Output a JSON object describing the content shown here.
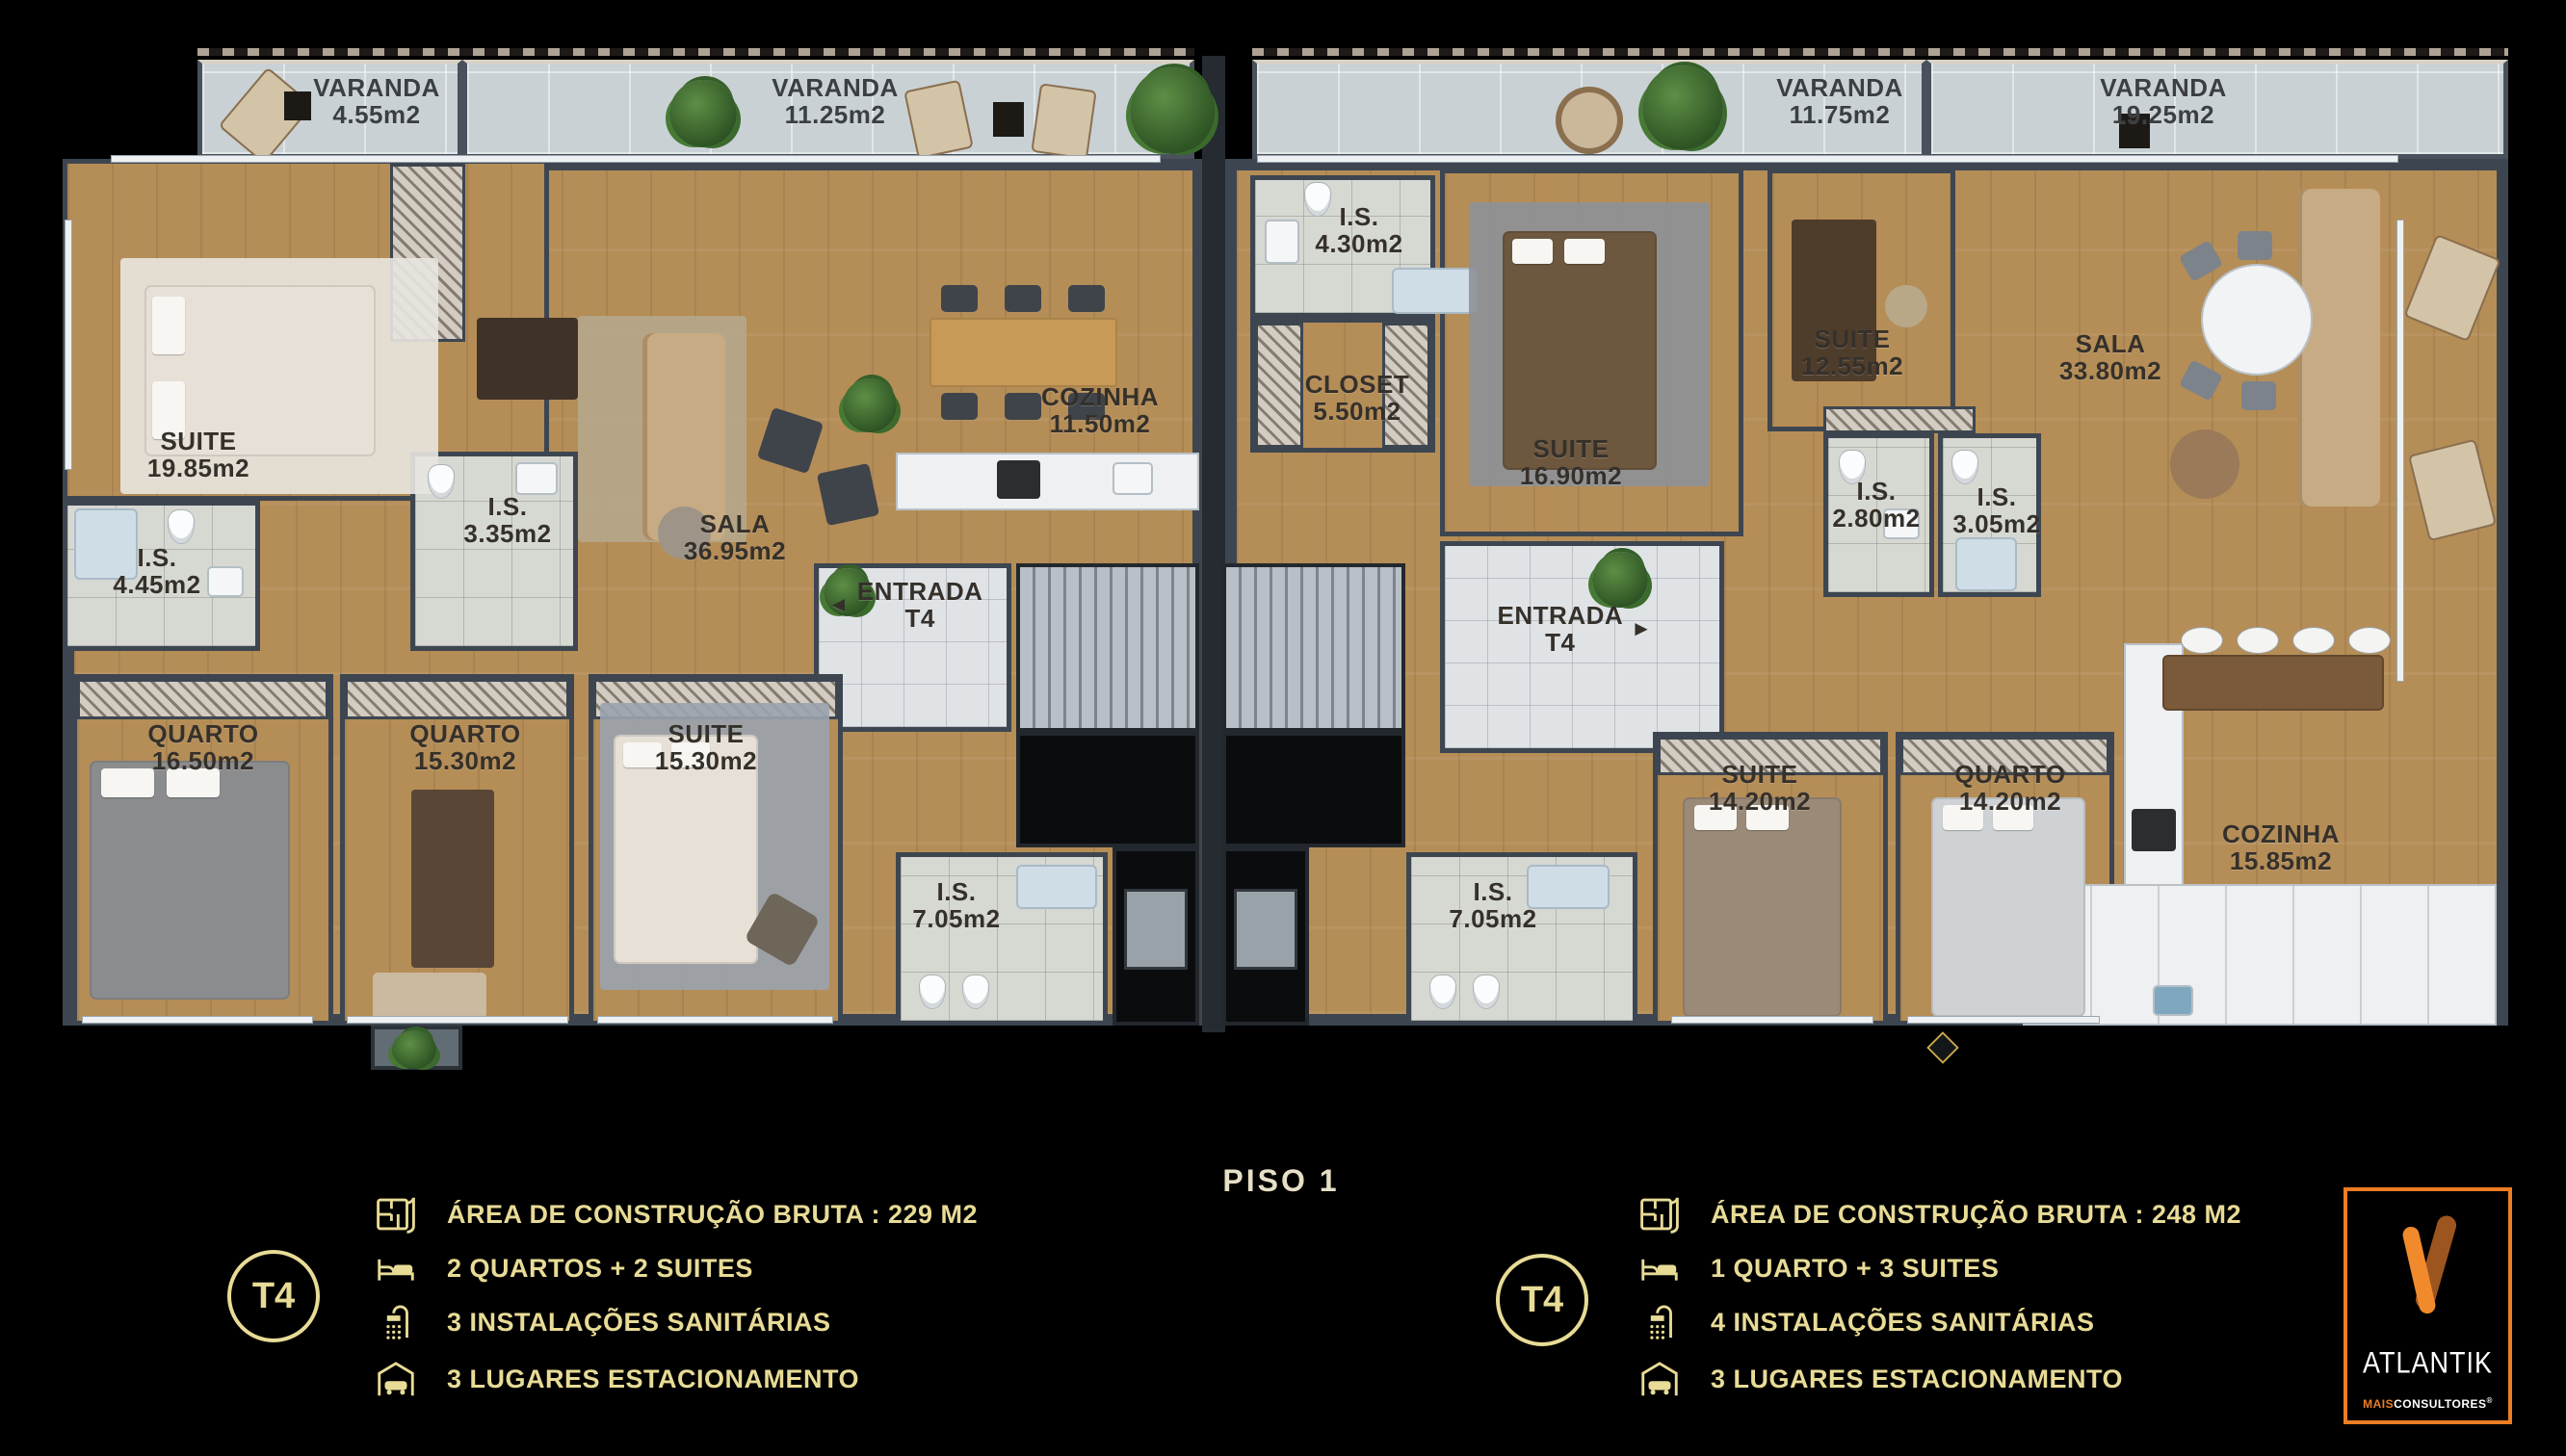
{
  "floor": {
    "label": "PISO 1"
  },
  "balconies": [
    {
      "name": "VARANDA",
      "area": "4.55m2"
    },
    {
      "name": "VARANDA",
      "area": "11.25m2"
    },
    {
      "name": "VARANDA",
      "area": "11.75m2"
    },
    {
      "name": "VARANDA",
      "area": "19.25m2"
    }
  ],
  "left_unit": {
    "rooms": [
      {
        "name": "SUITE",
        "area": "19.85m2"
      },
      {
        "name": "I.S.",
        "area": "4.45m2"
      },
      {
        "name": "I.S.",
        "area": "3.35m2"
      },
      {
        "name": "SALA",
        "area": "36.95m2"
      },
      {
        "name": "COZINHA",
        "area": "11.50m2"
      },
      {
        "name": "ENTRADA",
        "area": "T4"
      },
      {
        "name": "QUARTO",
        "area": "16.50m2"
      },
      {
        "name": "QUARTO",
        "area": "15.30m2"
      },
      {
        "name": "SUITE",
        "area": "15.30m2"
      },
      {
        "name": "I.S.",
        "area": "7.05m2"
      }
    ]
  },
  "right_unit": {
    "rooms": [
      {
        "name": "I.S.",
        "area": "4.30m2"
      },
      {
        "name": "CLOSET",
        "area": "5.50m2"
      },
      {
        "name": "SUITE",
        "area": "16.90m2"
      },
      {
        "name": "ENTRADA",
        "area": "T4"
      },
      {
        "name": "SUITE",
        "area": "12.55m2"
      },
      {
        "name": "I.S.",
        "area": "2.80m2"
      },
      {
        "name": "I.S.",
        "area": "3.05m2"
      },
      {
        "name": "SALA",
        "area": "33.80m2"
      },
      {
        "name": "I.S.",
        "area": "7.05m2"
      },
      {
        "name": "SUITE",
        "area": "14.20m2"
      },
      {
        "name": "QUARTO",
        "area": "14.20m2"
      },
      {
        "name": "COZINHA",
        "area": "15.85m2"
      }
    ]
  },
  "icons": {
    "arrow_left": "◄",
    "arrow_right": "►"
  },
  "legends": {
    "left": {
      "badge": "T4",
      "rows": [
        {
          "icon": "floorplan-icon",
          "text": "ÁREA DE CONSTRUÇÃO BRUTA :  229 M2"
        },
        {
          "icon": "bed-icon",
          "text": "2 QUARTOS + 2 SUITES"
        },
        {
          "icon": "shower-icon",
          "text": "3 INSTALAÇÕES SANITÁRIAS"
        },
        {
          "icon": "garage-icon",
          "text": "3 LUGARES ESTACIONAMENTO"
        }
      ]
    },
    "right": {
      "badge": "T4",
      "rows": [
        {
          "icon": "floorplan-icon",
          "text": "ÁREA DE CONSTRUÇÃO BRUTA :  248 M2"
        },
        {
          "icon": "bed-icon",
          "text": "1 QUARTO + 3 SUITES"
        },
        {
          "icon": "shower-icon",
          "text": "4 INSTALAÇÕES SANITÁRIAS"
        },
        {
          "icon": "garage-icon",
          "text": "3 LUGARES ESTACIONAMENTO"
        }
      ]
    }
  },
  "logo": {
    "brand": "ATLANTIK",
    "tagline_bold": "MAIS",
    "tagline_rest": "CONSULTORES",
    "registered": "®"
  },
  "colors": {
    "accent_gold": "#e8db96",
    "brand_orange": "#ed7d23",
    "wall": "#3d4650",
    "wood": "#b58d57",
    "balcony": "#c9d1d5",
    "tile": "#d6d8d2"
  }
}
